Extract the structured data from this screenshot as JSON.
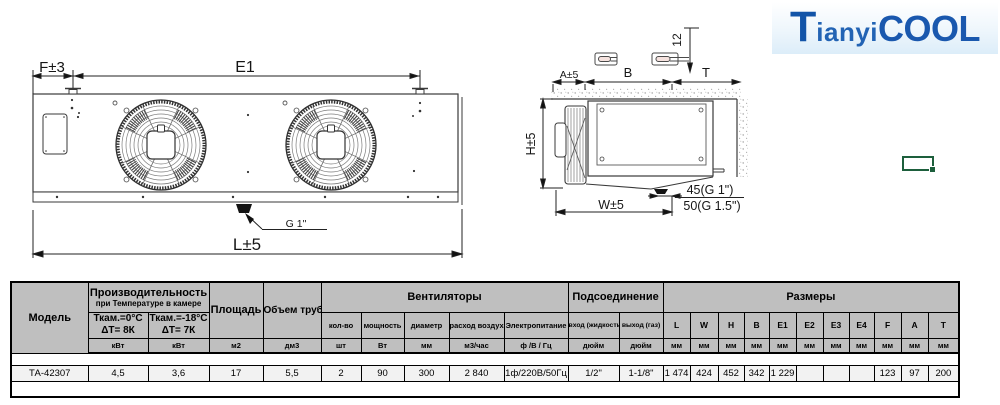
{
  "logo": {
    "t": "T",
    "ianyi": "ianyi",
    "cool": "COOL"
  },
  "front_view": {
    "dim_f": "F±3",
    "dim_e1": "E1",
    "dim_l": "L±5",
    "drain_label": "G 1\""
  },
  "side_view": {
    "offset_label": "12",
    "dim_a": "A±5",
    "dim_b": "B",
    "dim_t": "T",
    "dim_h": "H±5",
    "dim_w": "W±5",
    "drain_dim_top": "45(G 1\")",
    "drain_dim_bottom": "50(G 1.5\")"
  },
  "table": {
    "headers": {
      "model": "Модель",
      "capacity_group": "Производительность",
      "capacity_note": "при Температуре в камере",
      "cap1_line1": "Ткам.=0°С",
      "cap1_line2": "ΔТ= 8К",
      "cap2_line1": "Ткам.=-18°С",
      "cap2_line2": "ΔТ= 7К",
      "area": "Площадь",
      "tube_volume": "Объем труб",
      "fans_group": "Вентиляторы",
      "fan_qty": "кол-во",
      "fan_power": "мощность",
      "fan_diameter": "диаметр",
      "fan_airflow": "расход воздуха",
      "power_supply": "Электропитание",
      "connection_group": "Подсоединение",
      "inlet": "вход (жидкость)",
      "outlet": "выход (газ)",
      "dimensions_group": "Размеры",
      "dim_letters": [
        "L",
        "W",
        "H",
        "B",
        "E1",
        "E2",
        "E3",
        "E4",
        "F",
        "A",
        "T"
      ]
    },
    "units": [
      "кВт",
      "кВт",
      "м2",
      "дм3",
      "шт",
      "Вт",
      "мм",
      "м3/час",
      "ф /В / Гц",
      "дюйм",
      "дюйм",
      "мм",
      "мм",
      "мм",
      "мм",
      "мм",
      "мм",
      "мм",
      "мм",
      "мм",
      "мм",
      "мм"
    ],
    "data_row": {
      "model": "ТА-42307",
      "values": [
        "4,5",
        "3,6",
        "17",
        "5,5",
        "2",
        "90",
        "300",
        "2 840",
        "1ф/220В/50Гц",
        "1/2\"",
        "1-1/8\"",
        "1 474",
        "424",
        "452",
        "342",
        "1 229",
        "",
        "",
        "",
        "123",
        "97",
        "200"
      ]
    }
  }
}
